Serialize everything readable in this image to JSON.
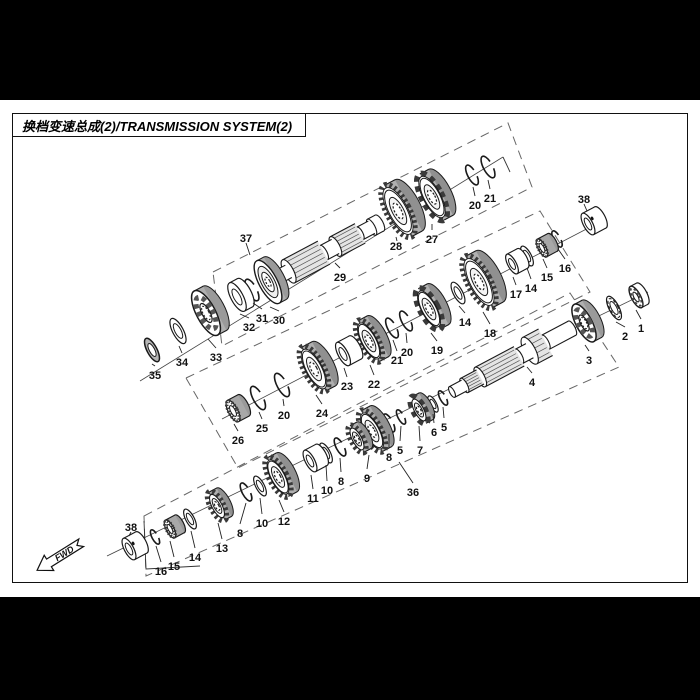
{
  "title": "换档变速总成(2)/TRANSMISSION SYSTEM(2)",
  "fwd_label": "FWD",
  "colors": {
    "line": "#1a1a1a",
    "dash": "#666666",
    "teeth": "#3a3a3a",
    "side": "#9a9a9a",
    "face": "#f4f4f4"
  },
  "diagram": {
    "boxes": [
      {
        "name": "dashed-box-37",
        "pts": [
          [
            213,
            272
          ],
          [
            508,
            123
          ],
          [
            532,
            187
          ],
          [
            222,
            346
          ]
        ]
      },
      {
        "name": "dashed-box-middle",
        "pts": [
          [
            186,
            378
          ],
          [
            540,
            211
          ],
          [
            590,
            292
          ],
          [
            238,
            468
          ]
        ]
      },
      {
        "name": "dashed-box-36",
        "pts": [
          [
            144,
            516
          ],
          [
            570,
            293
          ],
          [
            619,
            367
          ],
          [
            146,
            576
          ]
        ]
      }
    ],
    "axes": [
      [
        140,
        381,
        503,
        157
      ],
      [
        222,
        419,
        598,
        223
      ],
      [
        107,
        556,
        648,
        292
      ]
    ],
    "solids": [
      [
        [
          503,
          157
        ],
        [
          510,
          172
        ]
      ],
      [
        [
          144,
          521
        ],
        [
          146,
          569
        ],
        [
          200,
          566
        ]
      ]
    ],
    "callouts": [
      {
        "n": "35",
        "x": 155,
        "y": 375,
        "tx": 152,
        "ty": 364
      },
      {
        "n": "34",
        "x": 182,
        "y": 362,
        "tx": 179,
        "ty": 346
      },
      {
        "n": "33",
        "x": 216,
        "y": 357,
        "tx": 208,
        "ty": 339
      },
      {
        "n": "32",
        "x": 249,
        "y": 327,
        "tx": 240,
        "ty": 314
      },
      {
        "n": "31",
        "x": 262,
        "y": 318,
        "tx": 253,
        "ty": 303
      },
      {
        "n": "30",
        "x": 279,
        "y": 320,
        "tx": 270,
        "ty": 307
      },
      {
        "n": "29",
        "x": 340,
        "y": 277,
        "tx": 335,
        "ty": 263
      },
      {
        "n": "28",
        "x": 396,
        "y": 246,
        "tx": 397,
        "ty": 241
      },
      {
        "n": "27",
        "x": 432,
        "y": 239,
        "tx": 432,
        "ty": 224
      },
      {
        "n": "20",
        "x": 475,
        "y": 205,
        "tx": 473,
        "ty": 187
      },
      {
        "n": "21",
        "x": 490,
        "y": 198,
        "tx": 488,
        "ty": 180
      },
      {
        "n": "37",
        "x": 246,
        "y": 238,
        "tx": 250,
        "ty": 255
      },
      {
        "n": "38",
        "x": 584,
        "y": 199,
        "tx": 587,
        "ty": 211
      },
      {
        "n": "26",
        "x": 238,
        "y": 440,
        "tx": 234,
        "ty": 424
      },
      {
        "n": "25",
        "x": 262,
        "y": 428,
        "tx": 259,
        "ty": 412
      },
      {
        "n": "20",
        "x": 284,
        "y": 415,
        "tx": 283,
        "ty": 399
      },
      {
        "n": "24",
        "x": 322,
        "y": 413,
        "tx": 316,
        "ty": 395
      },
      {
        "n": "23",
        "x": 347,
        "y": 386,
        "tx": 344,
        "ty": 368
      },
      {
        "n": "22",
        "x": 374,
        "y": 384,
        "tx": 370,
        "ty": 365
      },
      {
        "n": "21",
        "x": 397,
        "y": 360,
        "tx": 393,
        "ty": 340
      },
      {
        "n": "20",
        "x": 407,
        "y": 352,
        "tx": 406,
        "ty": 333
      },
      {
        "n": "19",
        "x": 437,
        "y": 350,
        "tx": 431,
        "ty": 333
      },
      {
        "n": "14",
        "x": 465,
        "y": 322,
        "tx": 459,
        "ty": 306
      },
      {
        "n": "18",
        "x": 490,
        "y": 333,
        "tx": 483,
        "ty": 312
      },
      {
        "n": "17",
        "x": 516,
        "y": 294,
        "tx": 513,
        "ty": 277
      },
      {
        "n": "14",
        "x": 531,
        "y": 288,
        "tx": 527,
        "ty": 268
      },
      {
        "n": "15",
        "x": 547,
        "y": 277,
        "tx": 543,
        "ty": 259
      },
      {
        "n": "16",
        "x": 565,
        "y": 268,
        "tx": 558,
        "ty": 249
      },
      {
        "n": "38",
        "x": 131,
        "y": 527,
        "tx": 129,
        "ty": 536
      },
      {
        "n": "16",
        "x": 161,
        "y": 571,
        "tx": 156,
        "ty": 546
      },
      {
        "n": "15",
        "x": 174,
        "y": 566,
        "tx": 170,
        "ty": 541
      },
      {
        "n": "14",
        "x": 195,
        "y": 557,
        "tx": 191,
        "ty": 531
      },
      {
        "n": "13",
        "x": 222,
        "y": 548,
        "tx": 218,
        "ty": 523
      },
      {
        "n": "8",
        "x": 240,
        "y": 533,
        "tx": 246,
        "ty": 503
      },
      {
        "n": "10",
        "x": 262,
        "y": 523,
        "tx": 260,
        "ty": 498
      },
      {
        "n": "12",
        "x": 284,
        "y": 521,
        "tx": 279,
        "ty": 500
      },
      {
        "n": "11",
        "x": 313,
        "y": 498,
        "tx": 311,
        "ty": 475
      },
      {
        "n": "10",
        "x": 327,
        "y": 490,
        "tx": 326,
        "ty": 465
      },
      {
        "n": "8",
        "x": 341,
        "y": 481,
        "tx": 340,
        "ty": 458
      },
      {
        "n": "9",
        "x": 367,
        "y": 478,
        "tx": 369,
        "ty": 455
      },
      {
        "n": "8",
        "x": 389,
        "y": 457,
        "tx": 389,
        "ty": 434
      },
      {
        "n": "5",
        "x": 400,
        "y": 450,
        "tx": 401,
        "ty": 426
      },
      {
        "n": "7",
        "x": 420,
        "y": 450,
        "tx": 419,
        "ty": 426
      },
      {
        "n": "6",
        "x": 434,
        "y": 432,
        "tx": 433,
        "ty": 414
      },
      {
        "n": "5",
        "x": 444,
        "y": 427,
        "tx": 443,
        "ty": 407
      },
      {
        "n": "4",
        "x": 532,
        "y": 382,
        "tx": 527,
        "ty": 367
      },
      {
        "n": "3",
        "x": 589,
        "y": 360,
        "tx": 585,
        "ty": 345
      },
      {
        "n": "2",
        "x": 625,
        "y": 336,
        "tx": 616,
        "ty": 322
      },
      {
        "n": "1",
        "x": 641,
        "y": 328,
        "tx": 636,
        "ty": 310
      },
      {
        "n": "36",
        "x": 413,
        "y": 492,
        "tx": 399,
        "ty": 462
      }
    ],
    "parts": [
      {
        "n": "21",
        "t": "ring",
        "x": 488,
        "y": 167,
        "r": 12
      },
      {
        "n": "20",
        "t": "ring",
        "x": 472,
        "y": 175,
        "r": 11
      },
      {
        "n": "27",
        "t": "gearD",
        "x": 432,
        "y": 197,
        "r": 26,
        "d": 10
      },
      {
        "n": "28",
        "t": "gear",
        "x": 398,
        "y": 211,
        "r": 29,
        "d": 12
      },
      {
        "n": "29",
        "t": "shaft",
        "x": 278,
        "y": 277,
        "segs": [
          {
            "l": 12,
            "r": 7
          },
          {
            "l": 40,
            "r": 13,
            "s": 1
          },
          {
            "l": 13,
            "r": 8
          },
          {
            "l": 28,
            "r": 11,
            "s": 1
          },
          {
            "l": 13,
            "r": 7
          },
          {
            "l": 9,
            "r": 9
          }
        ]
      },
      {
        "n": "30",
        "t": "flange",
        "x": 268,
        "y": 282,
        "r": 24,
        "d": 8
      },
      {
        "n": "31",
        "t": "ring",
        "x": 252,
        "y": 290,
        "r": 12
      },
      {
        "n": "32",
        "t": "bushing",
        "x": 237,
        "y": 297,
        "r": 16,
        "l": 9
      },
      {
        "n": "33",
        "t": "bearing",
        "x": 206,
        "y": 313,
        "r": 25,
        "d": 10
      },
      {
        "n": "34",
        "t": "washer",
        "x": 178,
        "y": 331,
        "r": 14
      },
      {
        "n": "35",
        "t": "seal",
        "x": 152,
        "y": 350,
        "r": 13
      },
      {
        "n": "38",
        "t": "bushing",
        "x": 588,
        "y": 224,
        "r": 12,
        "l": 14,
        "dot": 1
      },
      {
        "n": "16",
        "t": "ring",
        "x": 557,
        "y": 239,
        "r": 9
      },
      {
        "n": "15",
        "t": "needle",
        "x": 542,
        "y": 248,
        "r": 10,
        "l": 12
      },
      {
        "n": "14",
        "t": "washer",
        "x": 527,
        "y": 256,
        "r": 11
      },
      {
        "n": "17",
        "t": "bushing",
        "x": 512,
        "y": 264,
        "r": 11,
        "l": 12
      },
      {
        "n": "18",
        "t": "gear",
        "x": 479,
        "y": 282,
        "r": 29,
        "d": 12
      },
      {
        "n": "14",
        "t": "washer",
        "x": 458,
        "y": 293,
        "r": 12
      },
      {
        "n": "19",
        "t": "gearD",
        "x": 429,
        "y": 309,
        "r": 23,
        "d": 10
      },
      {
        "n": "20",
        "t": "ring",
        "x": 406,
        "y": 321,
        "r": 11
      },
      {
        "n": "21",
        "t": "ring",
        "x": 392,
        "y": 328,
        "r": 11
      },
      {
        "n": "22",
        "t": "gear",
        "x": 369,
        "y": 341,
        "r": 23,
        "d": 10
      },
      {
        "n": "23",
        "t": "bushing",
        "x": 343,
        "y": 354,
        "r": 13,
        "l": 14
      },
      {
        "n": "24",
        "t": "gear",
        "x": 314,
        "y": 369,
        "r": 25,
        "d": 11
      },
      {
        "n": "20",
        "t": "ring",
        "x": 282,
        "y": 385,
        "r": 13
      },
      {
        "n": "25",
        "t": "ring",
        "x": 258,
        "y": 398,
        "r": 13
      },
      {
        "n": "26",
        "t": "needle",
        "x": 233,
        "y": 411,
        "r": 12,
        "l": 12
      },
      {
        "n": "1",
        "t": "nut",
        "x": 636,
        "y": 297,
        "r": 12,
        "l": 7
      },
      {
        "n": "2",
        "t": "wavy",
        "x": 614,
        "y": 308,
        "r": 13
      },
      {
        "n": "3",
        "t": "bearing",
        "x": 584,
        "y": 323,
        "r": 21,
        "d": 9
      },
      {
        "n": "4",
        "t": "shaft",
        "x": 452,
        "y": 392,
        "segs": [
          {
            "l": 14,
            "r": 6
          },
          {
            "l": 18,
            "r": 8,
            "s": 1
          },
          {
            "l": 44,
            "r": 11,
            "s": 1
          },
          {
            "l": 12,
            "r": 8
          },
          {
            "l": 18,
            "r": 15,
            "s": 1
          },
          {
            "l": 30,
            "r": 8
          }
        ]
      },
      {
        "n": "5",
        "t": "ring",
        "x": 443,
        "y": 398,
        "r": 8
      },
      {
        "n": "6",
        "t": "washer",
        "x": 433,
        "y": 404,
        "r": 9
      },
      {
        "n": "7",
        "t": "gearD",
        "x": 419,
        "y": 410,
        "r": 15,
        "d": 8
      },
      {
        "n": "5",
        "t": "ring",
        "x": 401,
        "y": 417,
        "r": 8
      },
      {
        "n": "8",
        "t": "ring",
        "x": 389,
        "y": 423,
        "r": 10
      },
      {
        "n": "9",
        "t": "gear",
        "x": 372,
        "y": 431,
        "r": 23,
        "d": 10
      },
      {
        "n": "9",
        "t": "gear",
        "x": 357,
        "y": 439,
        "r": 15,
        "d": 8
      },
      {
        "n": "8",
        "t": "ring",
        "x": 340,
        "y": 447,
        "r": 10
      },
      {
        "n": "10",
        "t": "washer",
        "x": 326,
        "y": 453,
        "r": 11
      },
      {
        "n": "11",
        "t": "bushing",
        "x": 310,
        "y": 461,
        "r": 12,
        "l": 13
      },
      {
        "n": "12",
        "t": "gear",
        "x": 278,
        "y": 477,
        "r": 22,
        "d": 10
      },
      {
        "n": "10",
        "t": "washer",
        "x": 260,
        "y": 486,
        "r": 11
      },
      {
        "n": "8",
        "t": "ring",
        "x": 246,
        "y": 492,
        "r": 10
      },
      {
        "n": "13",
        "t": "gear",
        "x": 217,
        "y": 506,
        "r": 16,
        "d": 8
      },
      {
        "n": "14",
        "t": "washer",
        "x": 190,
        "y": 519,
        "r": 11
      },
      {
        "n": "15",
        "t": "needle",
        "x": 170,
        "y": 529,
        "r": 10,
        "l": 11
      },
      {
        "n": "16",
        "t": "ring",
        "x": 155,
        "y": 537,
        "r": 8
      },
      {
        "n": "38",
        "t": "bushing",
        "x": 129,
        "y": 549,
        "r": 12,
        "l": 14,
        "dot": 1
      }
    ],
    "fwd": {
      "x": 60,
      "y": 556,
      "rot": -32
    }
  }
}
